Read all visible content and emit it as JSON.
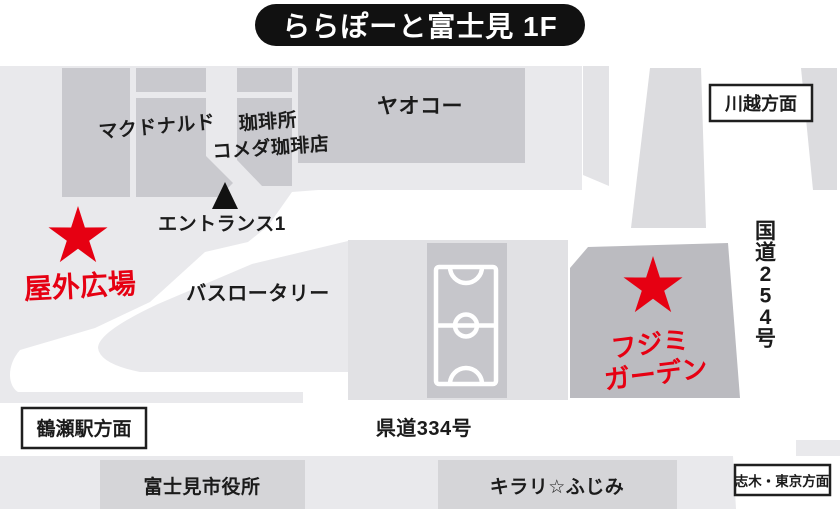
{
  "title": "ららぽーと富士見 1F",
  "colors": {
    "accent_red": "#e60012",
    "title_pill": "#111111",
    "road_white": "#ffffff",
    "base_gray": "#e9e9ec",
    "building_gray": "#c9c9ce",
    "garden_block_gray": "#bbbbc0"
  },
  "map": {
    "stores": {
      "mcdonalds": "マクドナルド",
      "coffee_place": "珈琲所",
      "komeda_coffee": "コメダ珈琲店",
      "yaoko": "ヤオコー"
    },
    "landmarks": {
      "entrance1": "エントランス1",
      "outdoor_plaza": "屋外広場",
      "bus_rotary": "バスロータリー",
      "fujimi_garden_line1": "フジミ",
      "fujimi_garden_line2": "ガーデン",
      "city_hall": "富士見市役所",
      "kirari_fujimi": "キラリ☆ふじみ"
    },
    "roads": {
      "prefectural_334": "県道334号",
      "national_254": "国道254号"
    },
    "directions": {
      "kawagoe": "川越方面",
      "tsuruse_station": "鶴瀬駅方面",
      "shiki_tokyo": "志木・東京方面"
    }
  }
}
